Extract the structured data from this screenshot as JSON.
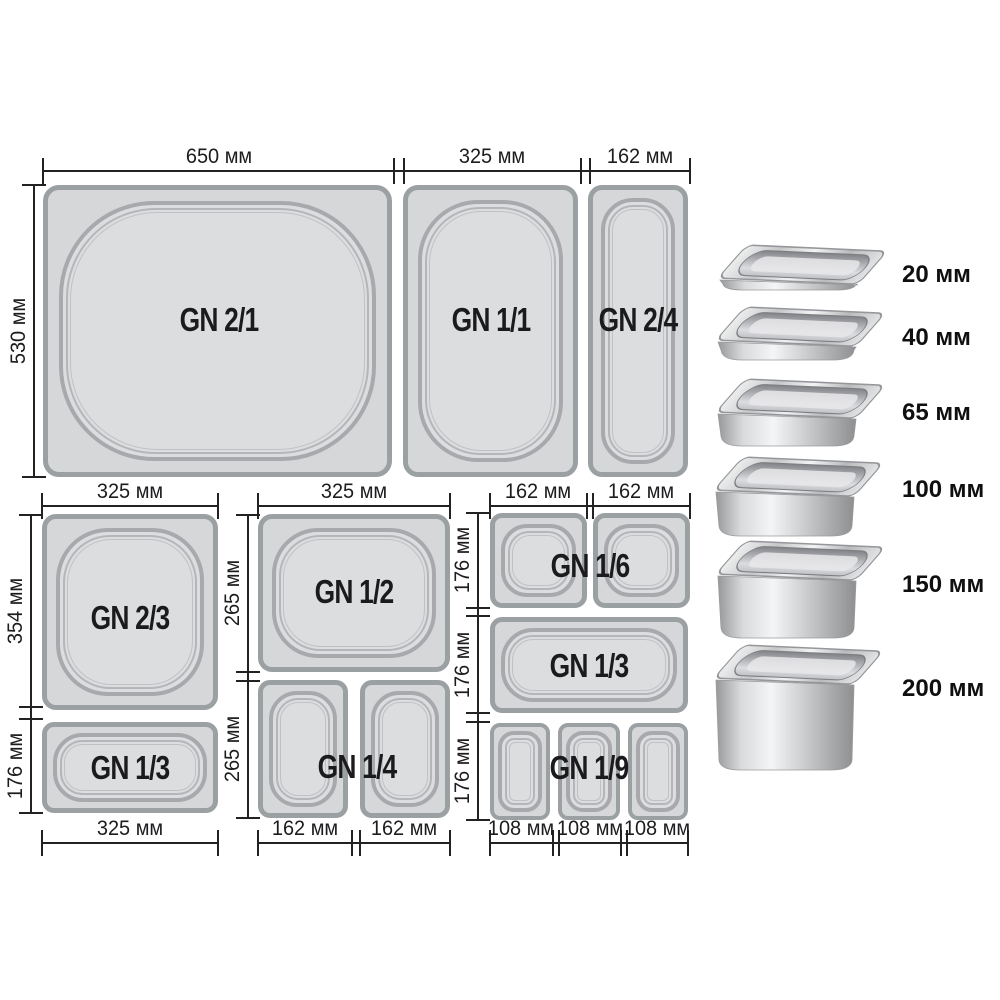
{
  "diagram": {
    "pans": [
      {
        "label": "GN 2/1"
      },
      {
        "label": "GN 1/1"
      },
      {
        "label": "GN 2/4"
      },
      {
        "label": "GN 2/3"
      },
      {
        "label": "GN 1/3"
      },
      {
        "label": "GN 1/2"
      },
      {
        "label": "GN 1/4"
      },
      {
        "label": "GN 1/6"
      },
      {
        "label": "GN 1/3"
      },
      {
        "label": "GN 1/9"
      }
    ],
    "top_row_widths": [
      "650 мм",
      "325 мм",
      "162 мм"
    ],
    "middle_row_widths": [
      "325 мм",
      "325 мм",
      "162 мм",
      "162 мм"
    ],
    "bottom_row_widths": [
      "325 мм",
      "162 мм",
      "162 мм",
      "108 мм",
      "108 мм",
      "108 мм"
    ],
    "side_heights": {
      "top_row": "530 мм",
      "left_column": [
        "354 мм",
        "176 мм"
      ],
      "middle_column": [
        "265 мм",
        "265 мм"
      ],
      "right_column": [
        "176 мм",
        "176 мм",
        "176 мм"
      ]
    }
  },
  "depth_scale": {
    "items": [
      {
        "label": "20 мм"
      },
      {
        "label": "40 мм"
      },
      {
        "label": "65 мм"
      },
      {
        "label": "100 мм"
      },
      {
        "label": "150 мм"
      },
      {
        "label": "200 мм"
      }
    ]
  },
  "colors": {
    "background": "#ffffff",
    "pan_fill": "#d6d7d9",
    "pan_border": "#9ba0a3",
    "dimension_line": "#222222",
    "text": "#1b1b1d"
  }
}
